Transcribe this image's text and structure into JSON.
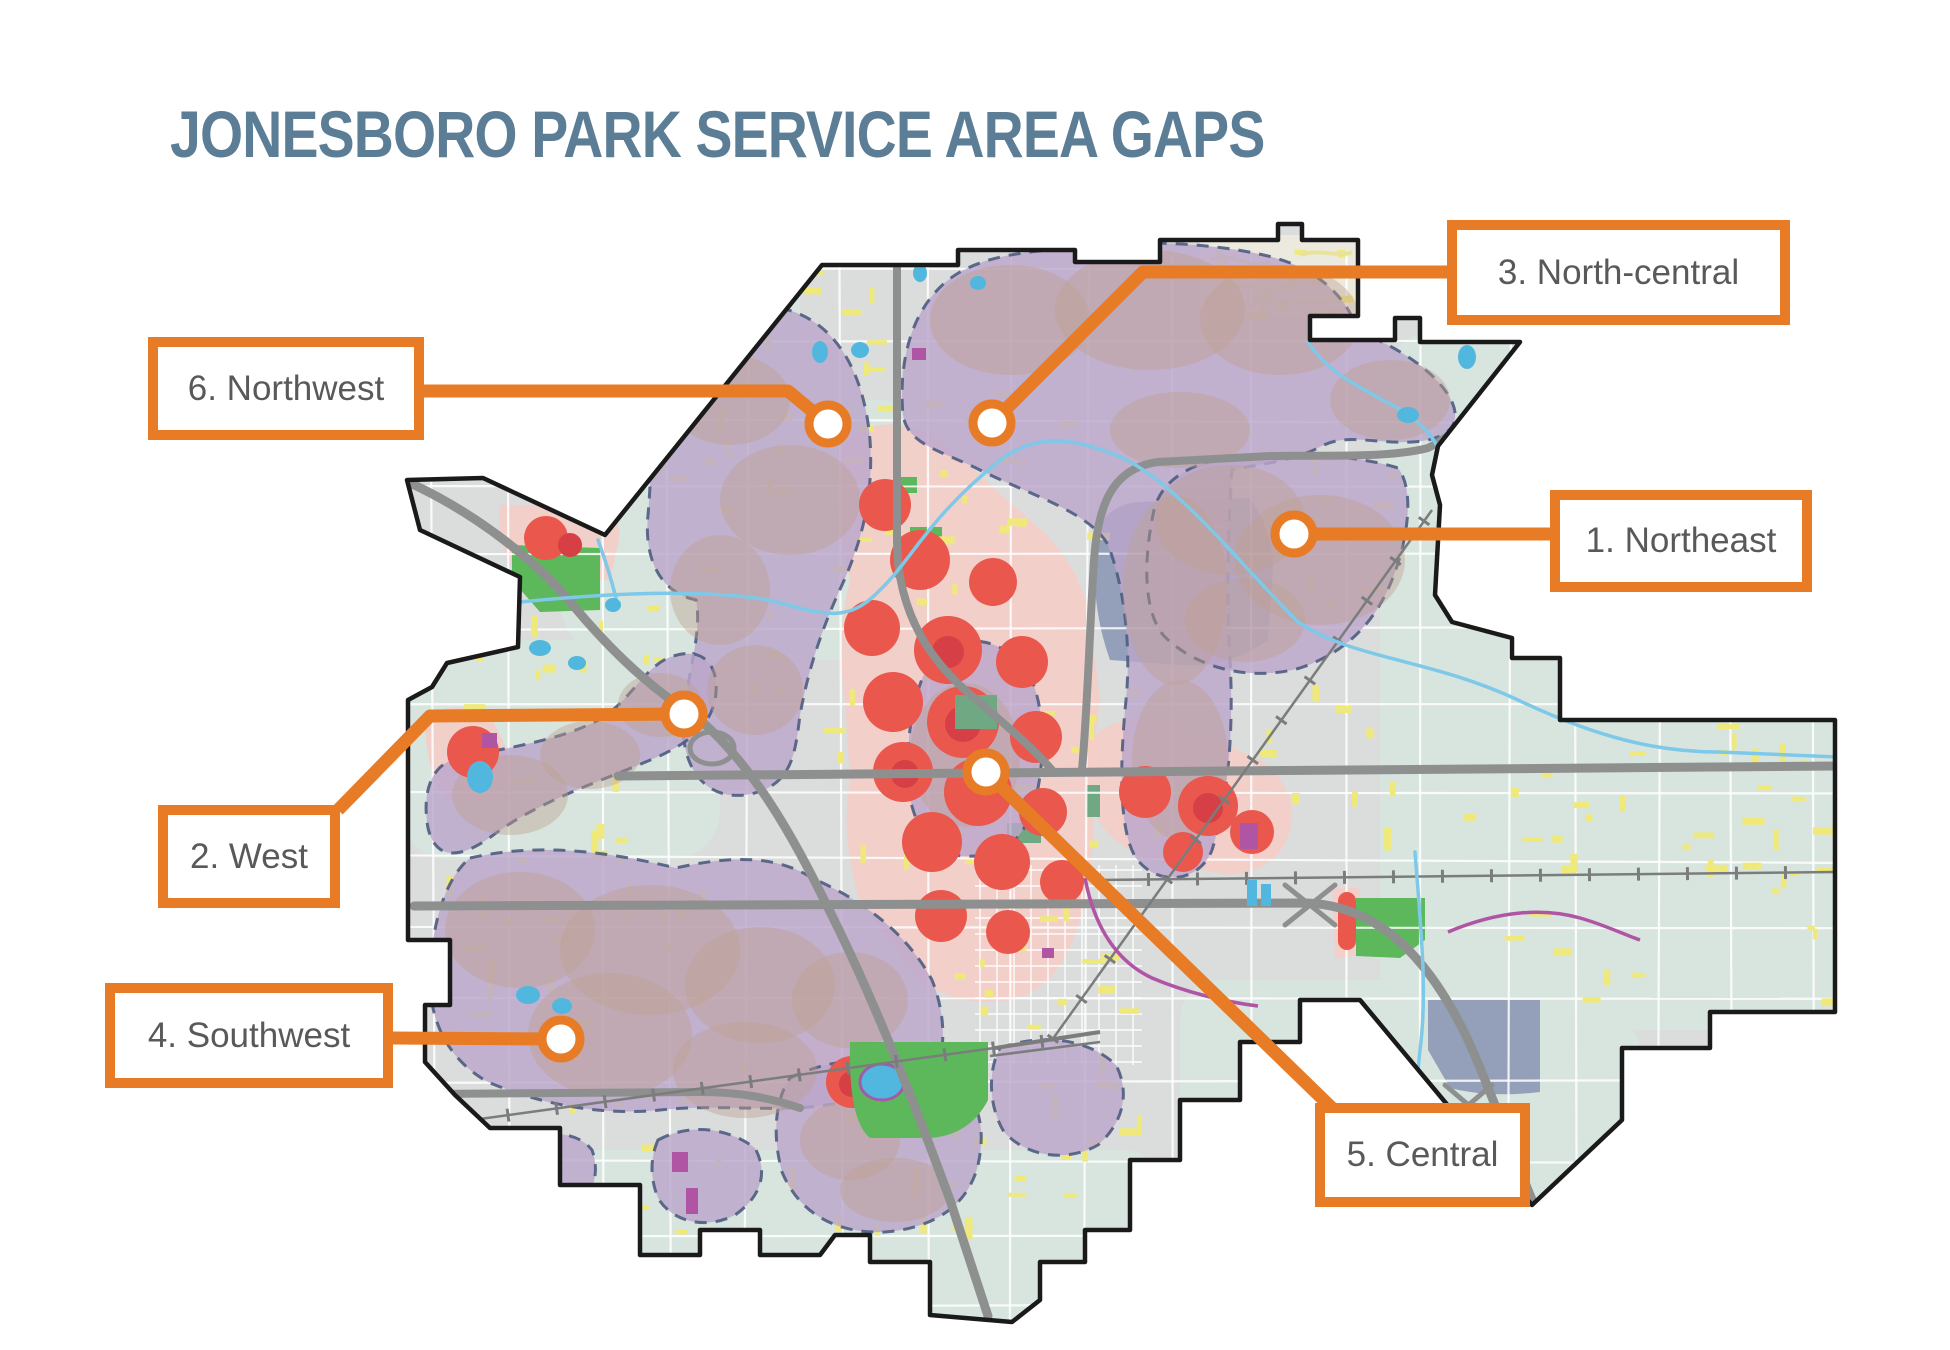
{
  "title": "JONESBORO PARK SERVICE AREA GAPS",
  "areas": [
    {
      "number": "1",
      "label": "1. Northeast",
      "region": "Northeast"
    },
    {
      "number": "2",
      "label": "2. West",
      "region": "West"
    },
    {
      "number": "3",
      "label": "3. North-central",
      "region": "North-central"
    },
    {
      "number": "4",
      "label": "4. Southwest",
      "region": "Southwest"
    },
    {
      "number": "5",
      "label": "5. Central",
      "region": "Central"
    },
    {
      "number": "6",
      "label": "6. Northwest",
      "region": "Northwest"
    }
  ],
  "theme": {
    "accent_orange": "#E87B25",
    "title_color": "#5B7D95",
    "label_color": "#58595B",
    "map_colors": {
      "city_base_gray": "#DADDDC",
      "green_tint": "#D8E5DE",
      "service_gap_purple": "#BBA6CB",
      "gap_dash_border": "#4E5C80",
      "heat_red": "#E9574D",
      "heat_halo_salmon": "#F7CDC7",
      "park_green": "#5CB85A",
      "water_blue": "#7EC8E8",
      "major_road_gray": "#8E9090",
      "minor_road_yellow": "#EFE97B",
      "urban_slate": "#94A0BA",
      "city_boundary_black": "#1A1A1A",
      "special_area_magenta": "#B054A4"
    }
  }
}
